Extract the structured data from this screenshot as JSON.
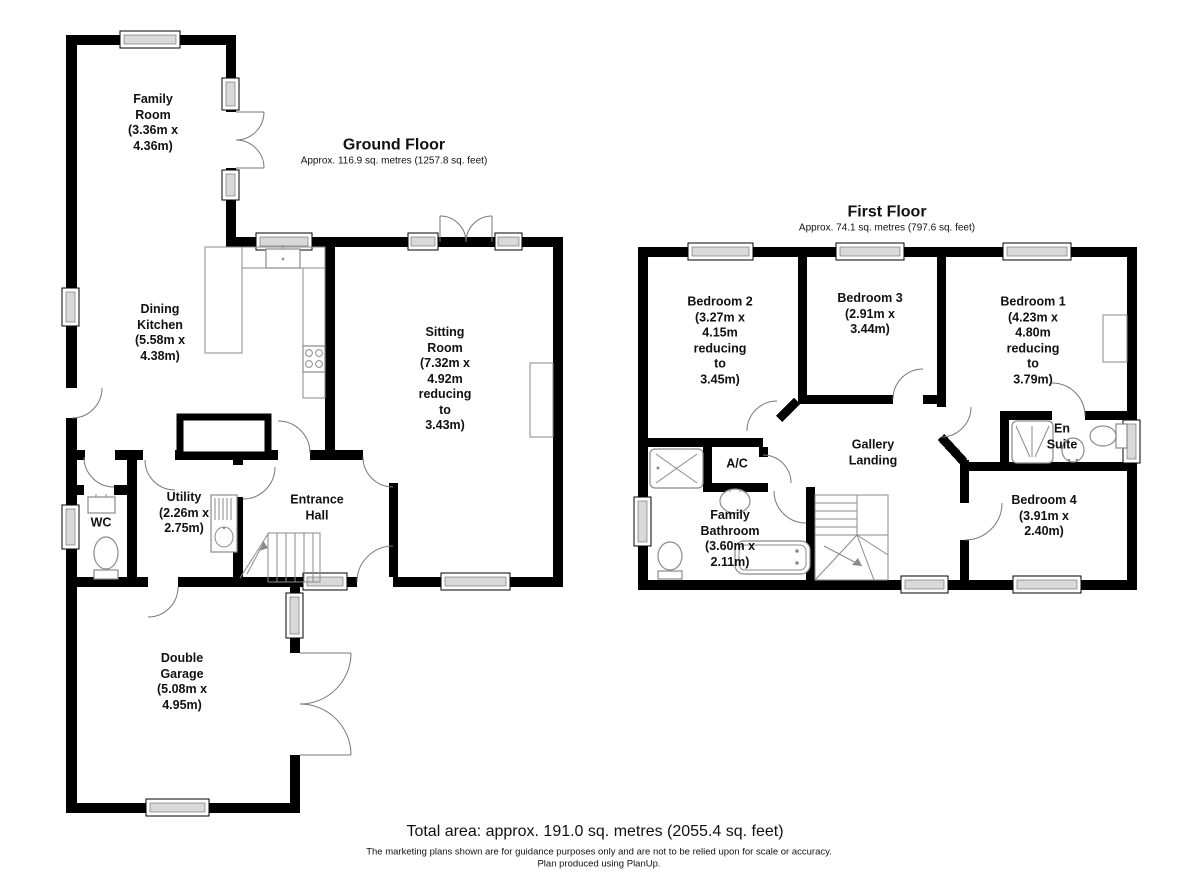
{
  "ground_floor": {
    "title": "Ground Floor",
    "subtitle": "Approx. 116.9 sq. metres (1257.8 sq. feet)",
    "rooms": {
      "family_room": "Family\nRoom\n(3.36m x\n4.36m)",
      "dining_kitchen": "Dining\nKitchen\n(5.58m x\n4.38m)",
      "sitting_room": "Sitting\nRoom\n(7.32m x\n4.92m\nreducing\nto\n3.43m)",
      "utility": "Utility\n(2.26m x\n2.75m)",
      "wc": "WC",
      "entrance_hall": "Entrance\nHall",
      "double_garage": "Double\nGarage\n(5.08m x\n4.95m)"
    }
  },
  "first_floor": {
    "title": "First Floor",
    "subtitle": "Approx. 74.1 sq. metres (797.6 sq. feet)",
    "rooms": {
      "bedroom2": "Bedroom 2\n(3.27m x\n4.15m\nreducing\nto\n3.45m)",
      "bedroom3": "Bedroom 3\n(2.91m x\n3.44m)",
      "bedroom1": "Bedroom 1\n(4.23m x\n4.80m\nreducing\nto\n3.79m)",
      "ac": "A/C",
      "gallery_landing": "Gallery\nLanding",
      "en_suite": "En\nSuite",
      "family_bathroom": "Family\nBathroom\n(3.60m x\n2.11m)",
      "bedroom4": "Bedroom 4\n(3.91m x\n2.40m)"
    }
  },
  "footer": {
    "total_area": "Total area: approx. 191.0 sq. metres (2055.4 sq. feet)",
    "disclaimer": "The marketing plans shown are for guidance purposes only and are not to be relied upon for scale or accuracy.\nPlan produced using PlanUp."
  },
  "colors": {
    "wall": "#000000",
    "window_fill": "#d9d9d9",
    "door_arc": "#777777",
    "fixture": "#8a8a8a"
  }
}
